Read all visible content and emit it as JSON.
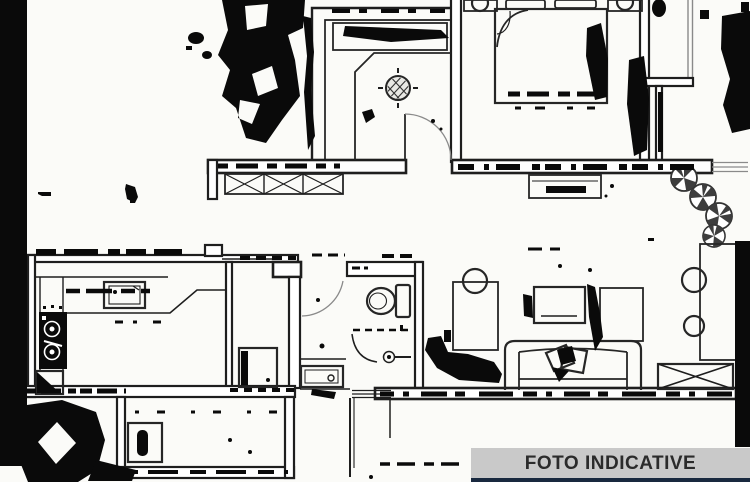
{
  "banner": {
    "label": "FOTO INDICATIVE"
  },
  "colors": {
    "plan_bg": "#fbfbf8",
    "plan_ink": "#1e1e1e",
    "artifact_black": "#0a0a0a",
    "banner_bg": "#c9c9c9",
    "banner_text": "#2b2b2b",
    "banner_accent": "#19293f"
  },
  "plan": {
    "type": "scanned black-and-white apartment floor plan, no text labels",
    "icon_names": [
      "double-bed-icon",
      "pillow-icon",
      "nightstand-lamp-icon",
      "wardrobe-icon",
      "ceiling-lamp-icon",
      "door-swing-icon",
      "window-hatch-icon",
      "bench-icon",
      "plant-icon",
      "shelf-unit-icon",
      "radiator-x-icon",
      "sofa-icon",
      "cushion-icon",
      "coffee-table-icon",
      "sideboard-icon",
      "desk-icon",
      "chair-icon",
      "kitchen-counter-icon",
      "kitchen-sink-icon",
      "stove-icon",
      "corner-cabinet-icon",
      "washing-machine-icon",
      "toilet-icon",
      "shower-drain-icon",
      "shower-curtain-icon",
      "bathroom-sink-icon",
      "scan-artifact-blobs"
    ]
  }
}
